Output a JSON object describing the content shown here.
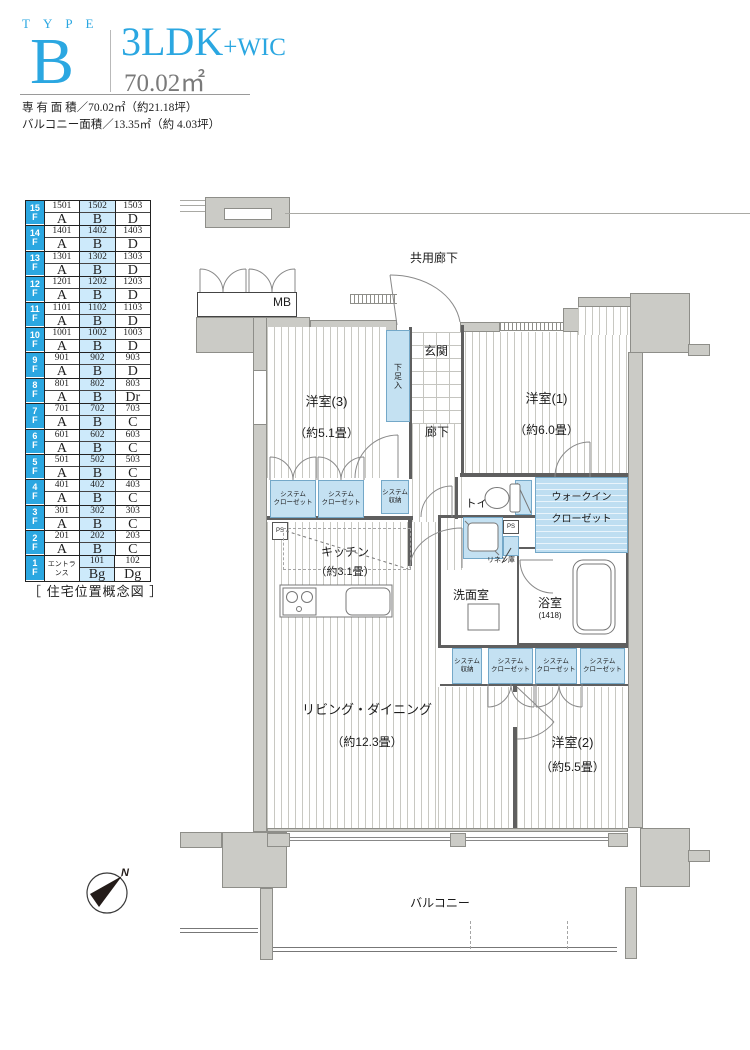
{
  "header": {
    "type_word": "TYPE",
    "type_letter": "B",
    "plan_type": "3LDK",
    "plan_suffix": "+WIC",
    "area": "70.02㎡",
    "spec_line1": "専 有 面 積／70.02㎡（約21.18坪）",
    "spec_line2": "バルコニー面積／13.35㎡（約 4.03坪）"
  },
  "position_table": {
    "caption": "［ 住宅位置概念図 ］",
    "floor_suffix": "F",
    "highlight_column": 1,
    "accent_color": "#2ba7e1",
    "highlight_color": "#cdeafb",
    "floors": [
      {
        "floor": "15",
        "cells": [
          {
            "no": "1501",
            "type": "A"
          },
          {
            "no": "1502",
            "type": "B"
          },
          {
            "no": "1503",
            "type": "D"
          }
        ]
      },
      {
        "floor": "14",
        "cells": [
          {
            "no": "1401",
            "type": "A"
          },
          {
            "no": "1402",
            "type": "B"
          },
          {
            "no": "1403",
            "type": "D"
          }
        ]
      },
      {
        "floor": "13",
        "cells": [
          {
            "no": "1301",
            "type": "A"
          },
          {
            "no": "1302",
            "type": "B"
          },
          {
            "no": "1303",
            "type": "D"
          }
        ]
      },
      {
        "floor": "12",
        "cells": [
          {
            "no": "1201",
            "type": "A"
          },
          {
            "no": "1202",
            "type": "B"
          },
          {
            "no": "1203",
            "type": "D"
          }
        ]
      },
      {
        "floor": "11",
        "cells": [
          {
            "no": "1101",
            "type": "A"
          },
          {
            "no": "1102",
            "type": "B"
          },
          {
            "no": "1103",
            "type": "D"
          }
        ]
      },
      {
        "floor": "10",
        "cells": [
          {
            "no": "1001",
            "type": "A"
          },
          {
            "no": "1002",
            "type": "B"
          },
          {
            "no": "1003",
            "type": "D"
          }
        ]
      },
      {
        "floor": "9",
        "cells": [
          {
            "no": "901",
            "type": "A"
          },
          {
            "no": "902",
            "type": "B"
          },
          {
            "no": "903",
            "type": "D"
          }
        ]
      },
      {
        "floor": "8",
        "cells": [
          {
            "no": "801",
            "type": "A"
          },
          {
            "no": "802",
            "type": "B"
          },
          {
            "no": "803",
            "type": "Dr"
          }
        ]
      },
      {
        "floor": "7",
        "cells": [
          {
            "no": "701",
            "type": "A"
          },
          {
            "no": "702",
            "type": "B"
          },
          {
            "no": "703",
            "type": "C"
          }
        ]
      },
      {
        "floor": "6",
        "cells": [
          {
            "no": "601",
            "type": "A"
          },
          {
            "no": "602",
            "type": "B"
          },
          {
            "no": "603",
            "type": "C"
          }
        ]
      },
      {
        "floor": "5",
        "cells": [
          {
            "no": "501",
            "type": "A"
          },
          {
            "no": "502",
            "type": "B"
          },
          {
            "no": "503",
            "type": "C"
          }
        ]
      },
      {
        "floor": "4",
        "cells": [
          {
            "no": "401",
            "type": "A"
          },
          {
            "no": "402",
            "type": "B"
          },
          {
            "no": "403",
            "type": "C"
          }
        ]
      },
      {
        "floor": "3",
        "cells": [
          {
            "no": "301",
            "type": "A"
          },
          {
            "no": "302",
            "type": "B"
          },
          {
            "no": "303",
            "type": "C"
          }
        ]
      },
      {
        "floor": "2",
        "cells": [
          {
            "no": "201",
            "type": "A"
          },
          {
            "no": "202",
            "type": "B"
          },
          {
            "no": "203",
            "type": "C"
          }
        ]
      },
      {
        "floor": "1",
        "cells": [
          {
            "label": "エントランス"
          },
          {
            "no": "101",
            "type": "Bg"
          },
          {
            "no": "102",
            "type": "Dg"
          }
        ]
      }
    ]
  },
  "plan": {
    "common_corridor": "共用廊下",
    "mb": "MB",
    "genkan": "玄関",
    "shoe_box": "下足入",
    "bedroom3_name": "洋室(3)",
    "bedroom3_size": "（約5.1畳）",
    "bedroom1_name": "洋室(1)",
    "bedroom1_size": "（約6.0畳）",
    "corridor": "廊下",
    "closet_line1": "システム",
    "closet_line2": "クローゼット",
    "storage_line1": "システム",
    "storage_line2": "収納",
    "toilet": "トイレ",
    "wic_line1": "ウォークイン",
    "wic_line2": "クローゼット",
    "ps": "PS",
    "kitchen_name": "キッチン",
    "kitchen_size": "（約3.1畳）",
    "linen": "リネン庫",
    "washroom": "洗面室",
    "bath_name": "浴室",
    "bath_size": "(1418)",
    "ld_name": "リビング・ダイニング",
    "ld_size": "（約12.3畳）",
    "bedroom2_name": "洋室(2)",
    "bedroom2_size": "（約5.5畳）",
    "balcony": "バルコニー"
  },
  "compass": {
    "north": "N"
  }
}
